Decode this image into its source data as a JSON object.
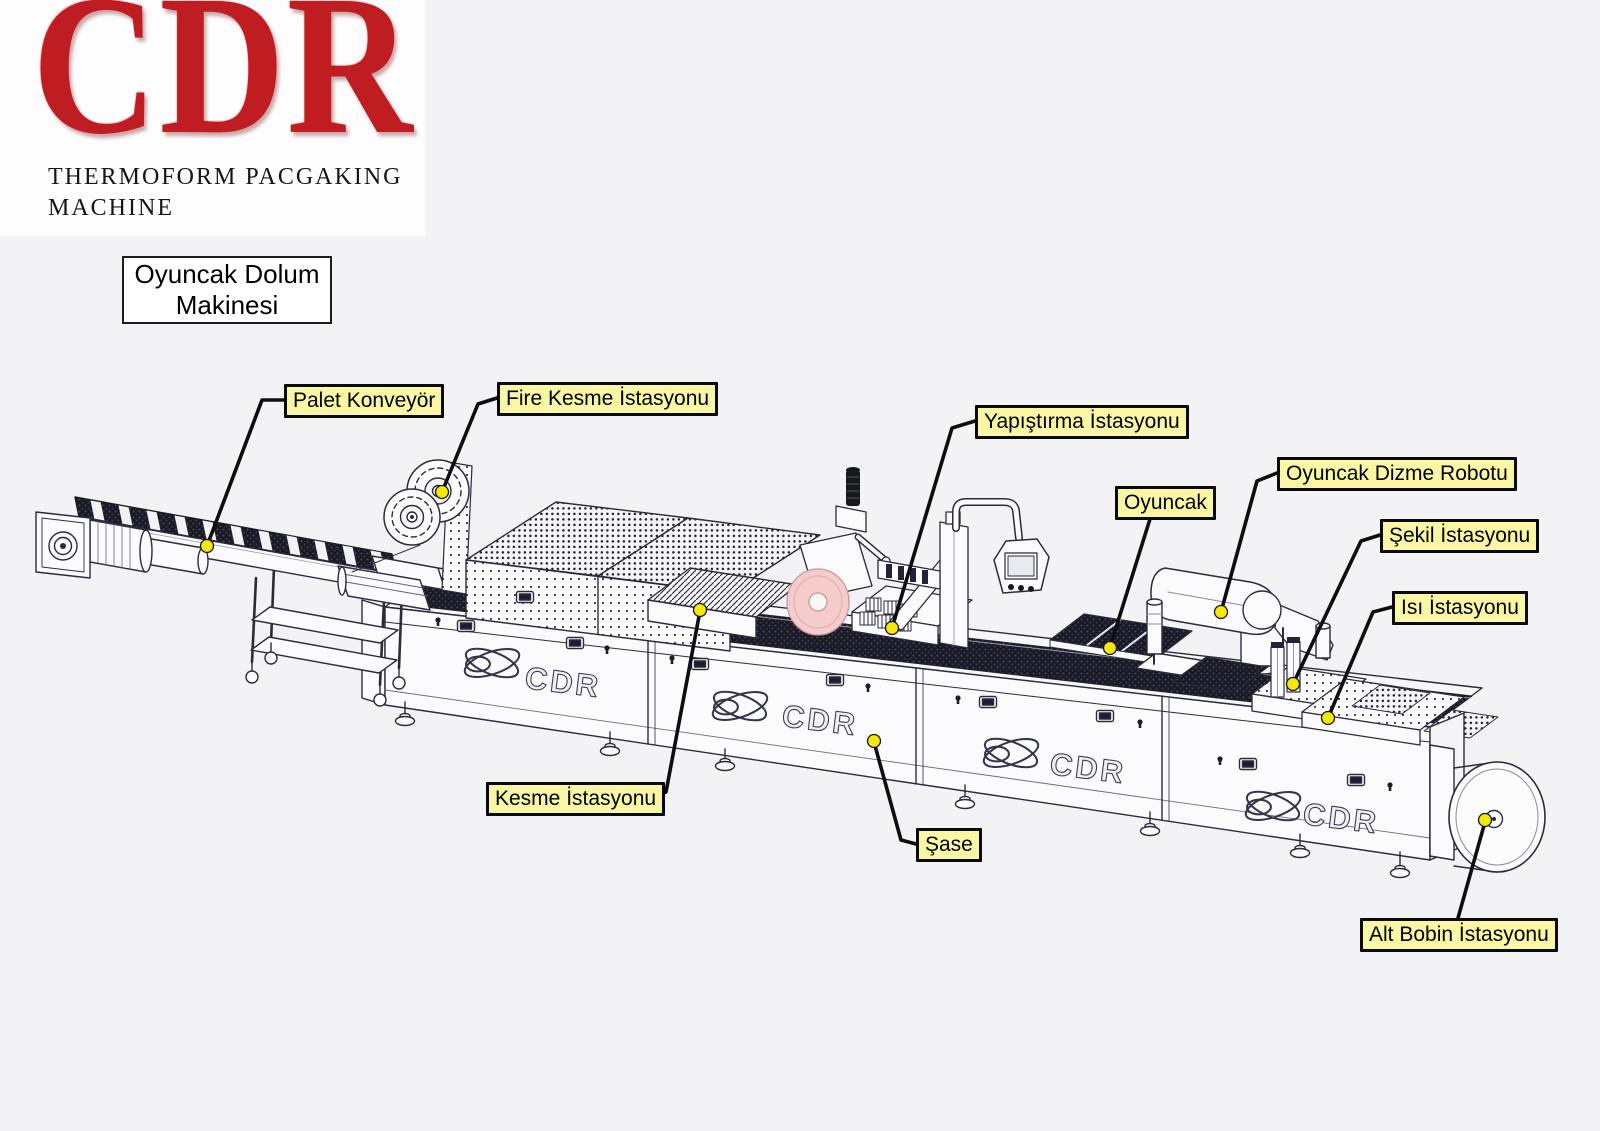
{
  "logo": {
    "brand": "CDR",
    "subtitle_line1": "THERMOFORM PACGAKING",
    "subtitle_line2": "MACHINE"
  },
  "machine_title": {
    "line1": "Oyuncak Dolum",
    "line2": "Makinesi"
  },
  "machine": {
    "panel_brand": "CDR"
  },
  "labels": [
    {
      "id": "palet-konveyor",
      "text": "Palet Konveyör"
    },
    {
      "id": "fire-kesme-istasyonu",
      "text": "Fire Kesme İstasyonu"
    },
    {
      "id": "yapistirma-istasyonu",
      "text": "Yapıştırma İstasyonu"
    },
    {
      "id": "oyuncak",
      "text": "Oyuncak"
    },
    {
      "id": "oyuncak-dizme-robotu",
      "text": "Oyuncak Dizme Robotu"
    },
    {
      "id": "sekil-istasyonu",
      "text": "Şekil İstasyonu"
    },
    {
      "id": "isi-istasyonu",
      "text": "Isı İstasyonu"
    },
    {
      "id": "kesme-istasyonu",
      "text": "Kesme İstasyonu"
    },
    {
      "id": "sase",
      "text": "Şase"
    },
    {
      "id": "alt-bobin-istasyonu",
      "text": "Alt Bobin İstasyonu"
    }
  ],
  "colors": {
    "background": "#f3f3f5",
    "label_background": "#f9f7a3",
    "label_border": "#000000",
    "marker_yellow": "#f4e70a",
    "logo_red": "#bf1d21",
    "line_art": "#2b2b3e",
    "film_roll_pink": "#f5cbcb"
  }
}
